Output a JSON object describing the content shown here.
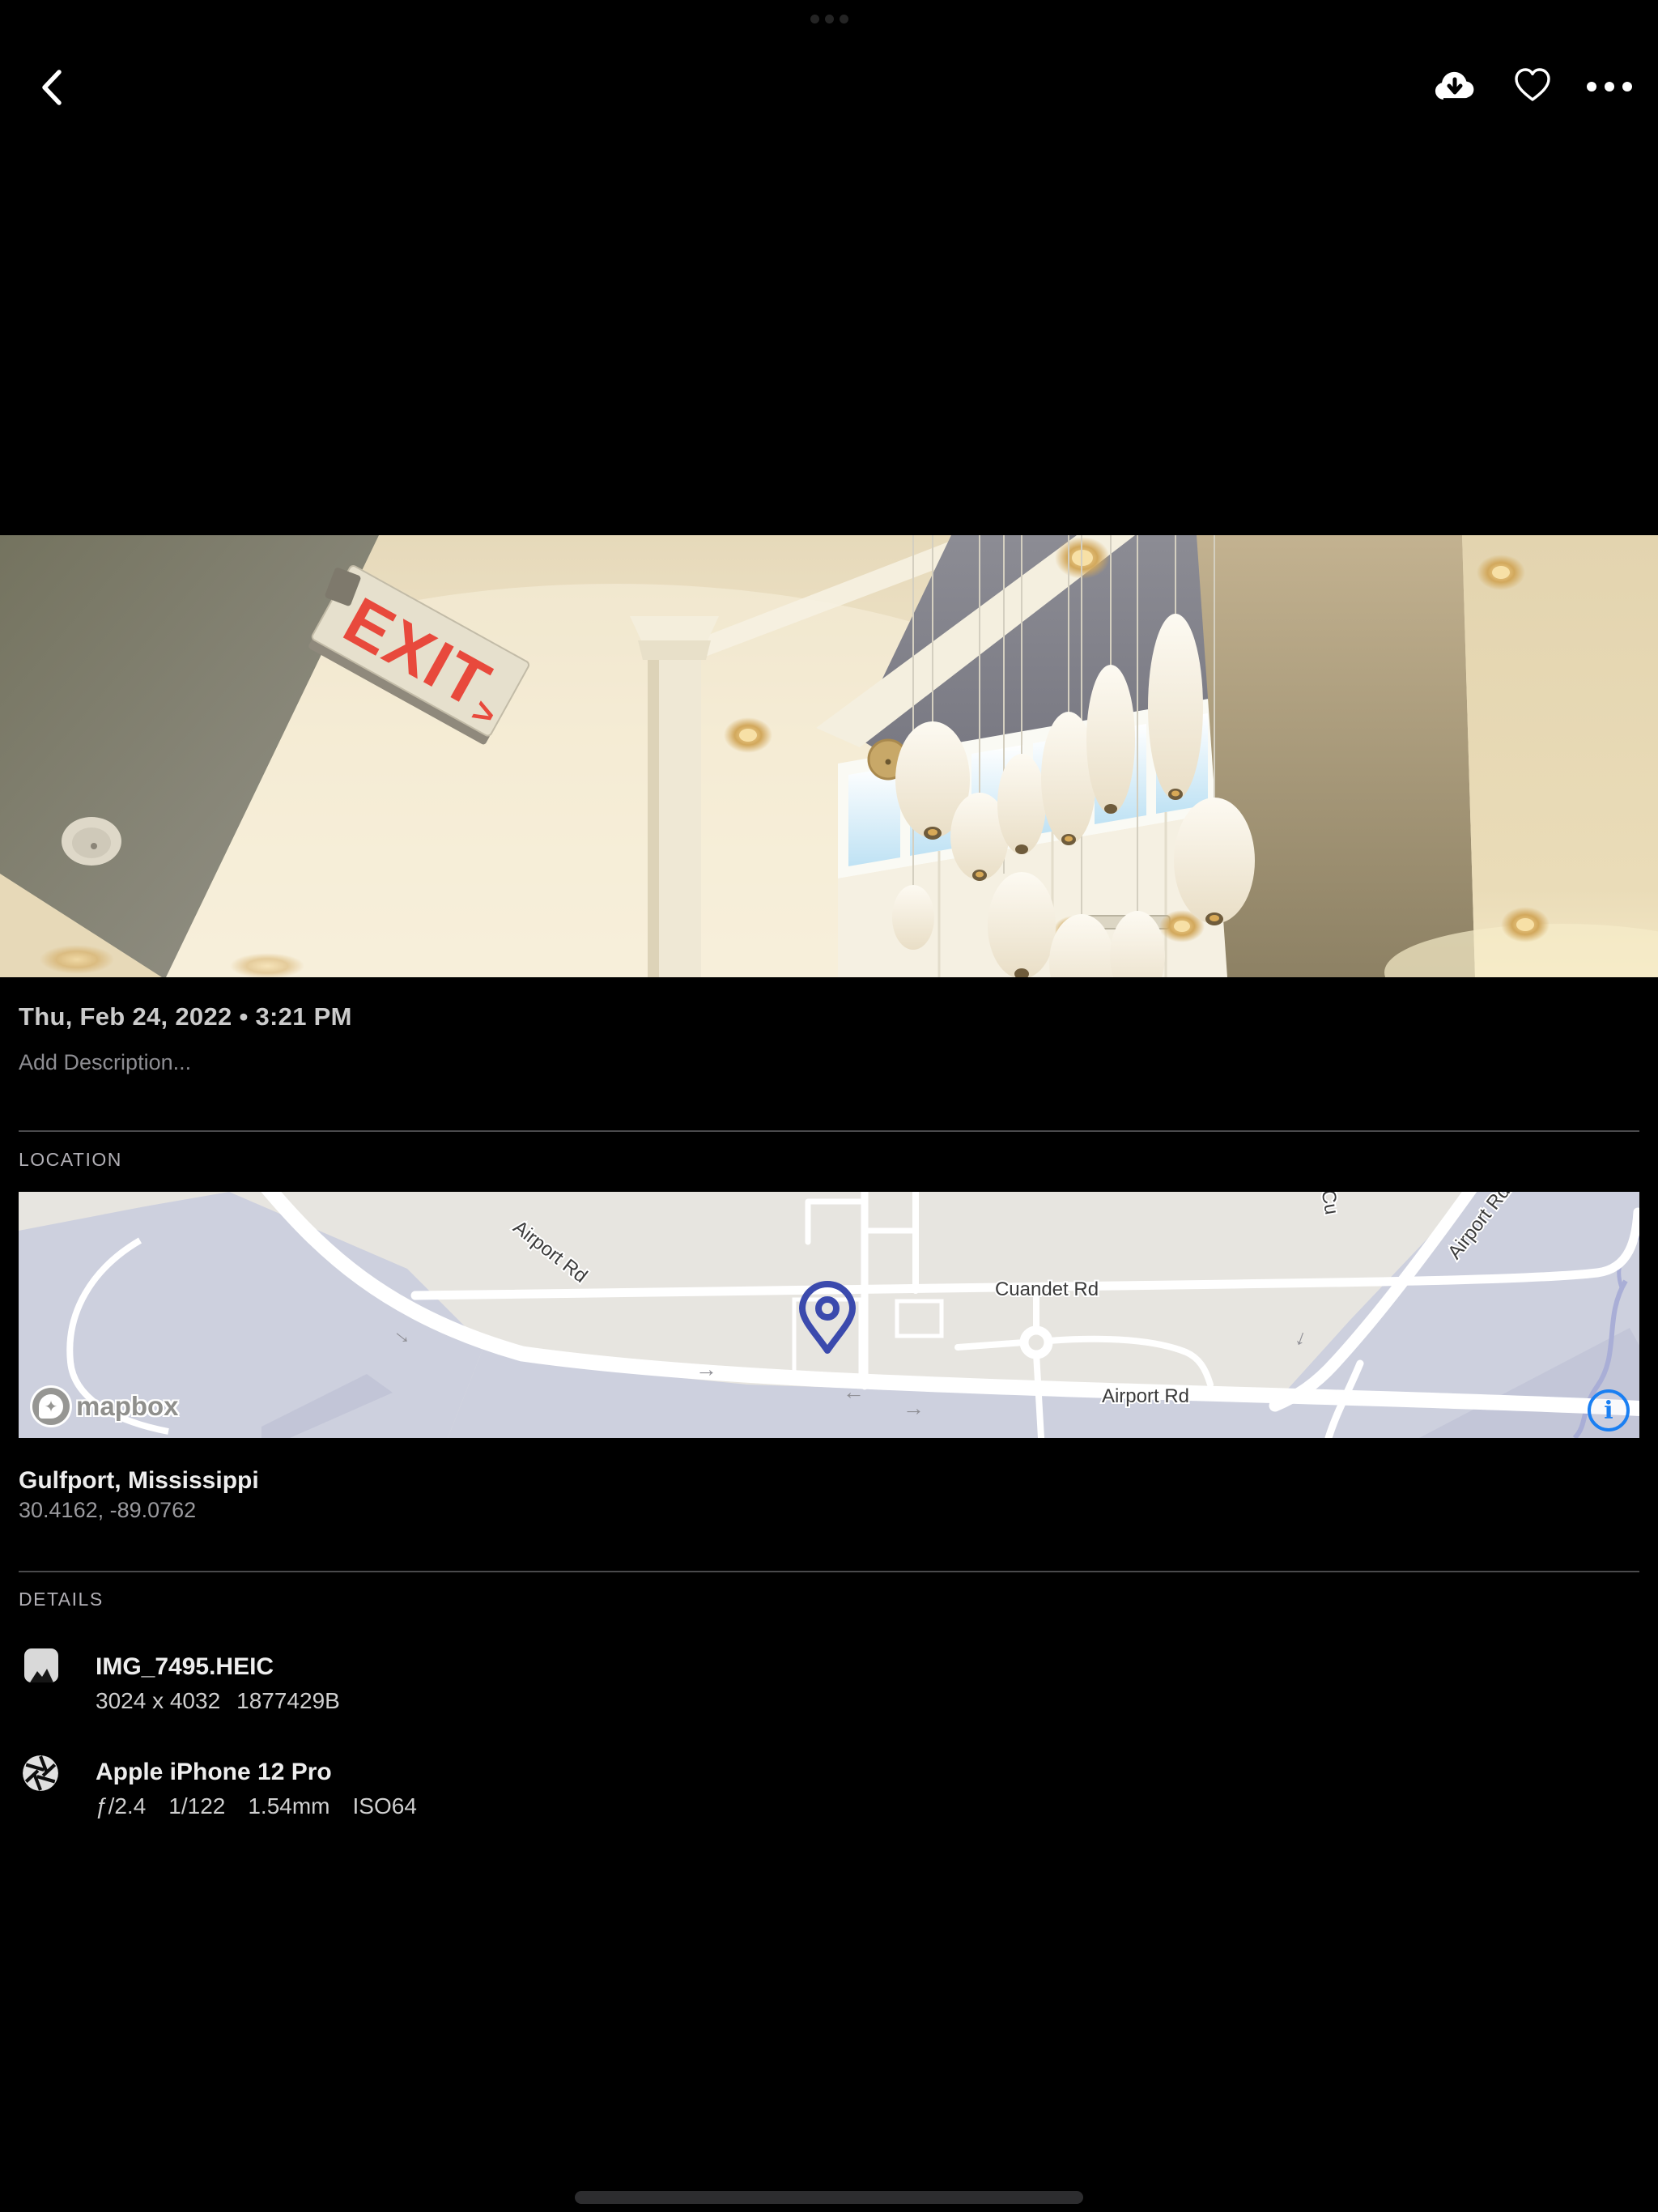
{
  "toolbar": {
    "back_icon": "chevron-left",
    "download_icon": "cloud-download",
    "favorite_icon": "heart-outline",
    "more_icon": "ellipsis"
  },
  "photo": {
    "exit_sign_text": "EXIT",
    "exit_sign_arrow": ">"
  },
  "meta": {
    "date_line": "Thu, Feb 24, 2022 • 3:21 PM",
    "description_placeholder": "Add Description..."
  },
  "location": {
    "header": "LOCATION",
    "place": "Gulfport, Mississippi",
    "coordinates": "30.4162, -89.0762",
    "map": {
      "label_airport_rd_diagonal": "Airport Rd",
      "label_cuandet_rd": "Cuandet Rd",
      "label_airport_rd_bottom": "Airport Rd",
      "label_airport_partial": "Airport Rd",
      "label_cu_partial": "Cu",
      "attribution": "mapbox",
      "info_glyph": "i",
      "pin_color": "#3b4aad",
      "info_color": "#1a7ff2"
    }
  },
  "details": {
    "header": "DETAILS",
    "file": {
      "title": "IMG_7495.HEIC",
      "dimensions": "3024 x 4032",
      "size": "1877429B"
    },
    "camera": {
      "title": "Apple iPhone 12 Pro",
      "aperture": "ƒ/2.4",
      "shutter": "1/122",
      "focal": "1.54mm",
      "iso": "ISO64"
    }
  },
  "colors": {
    "background": "#000000",
    "exit_red": "#e8493c",
    "map_land": "#e7e5e0",
    "map_zone": "#cdd0de"
  }
}
